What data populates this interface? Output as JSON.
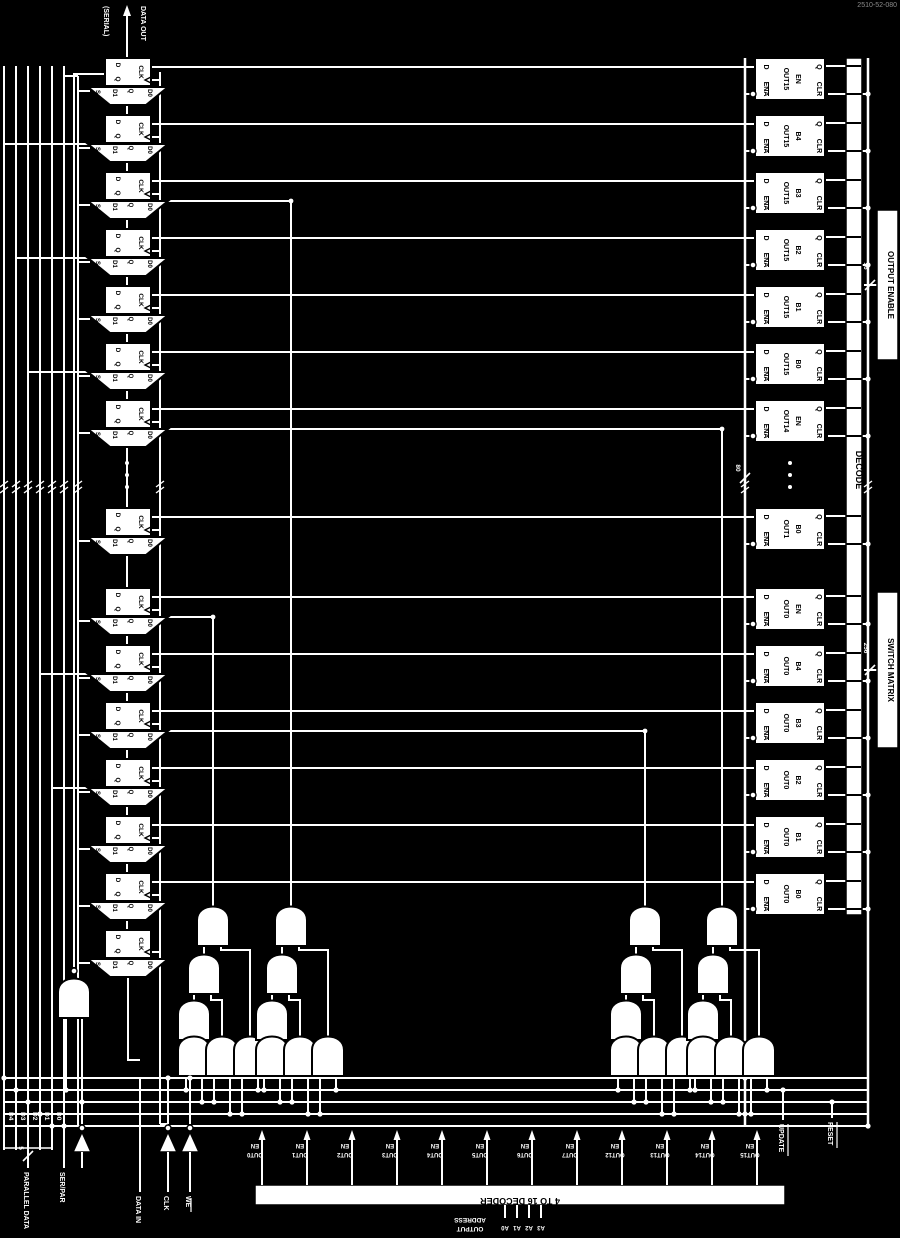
{
  "watermark": "2510-52-080",
  "colors": {
    "background": "#000000",
    "wire": "#ffffff",
    "block_fill": "#ffffff",
    "block_stroke": "#000000",
    "block_text": "#000000",
    "label_text": "#ffffff",
    "watermark_gray": "#8c8c8c"
  },
  "side_labels": {
    "decode": "DECODE",
    "output_enable": "OUTPUT ENABLE",
    "switch_matrix": "SWITCH MATRIX"
  },
  "bus_markers": {
    "enable_bus": "16",
    "matrix_bus": "256",
    "parallel_bus": "5",
    "register_bus": "80"
  },
  "latch_pins": {
    "ena": "ENA",
    "d": "D",
    "clr": "CLR",
    "q": "Q"
  },
  "ff_pins": {
    "d": "D",
    "q": "Q",
    "clk": "CLK"
  },
  "mux_pins": {
    "s": "S",
    "d1": "D1",
    "d0": "D0",
    "q": "Q"
  },
  "latches": [
    {
      "name": "OUT15",
      "bit": "EN"
    },
    {
      "name": "OUT15",
      "bit": "B4"
    },
    {
      "name": "OUT15",
      "bit": "B3"
    },
    {
      "name": "OUT15",
      "bit": "B2"
    },
    {
      "name": "OUT15",
      "bit": "B1"
    },
    {
      "name": "OUT15",
      "bit": "B0"
    },
    {
      "name": "OUT14",
      "bit": "EN"
    },
    {
      "name": "OUT1",
      "bit": "B0"
    },
    {
      "name": "OUT0",
      "bit": "EN"
    },
    {
      "name": "OUT0",
      "bit": "B4"
    },
    {
      "name": "OUT0",
      "bit": "B3"
    },
    {
      "name": "OUT0",
      "bit": "B2"
    },
    {
      "name": "OUT0",
      "bit": "B1"
    },
    {
      "name": "OUT0",
      "bit": "B0"
    }
  ],
  "decoder": {
    "title": "4 TO 16 DECODER",
    "outputs": [
      "OUT0 EN",
      "OUT1 EN",
      "OUT2 EN",
      "OUT3 EN",
      "OUT4 EN",
      "OUT5 EN",
      "OUT6 EN",
      "OUT7 EN",
      "OUT12 EN",
      "OUT13 EN",
      "OUT14 EN",
      "OUT15 EN"
    ],
    "address_pins": [
      "A0",
      "A1",
      "A2",
      "A3"
    ],
    "address_label_line1": "OUTPUT",
    "address_label_line2": "ADDRESS"
  },
  "bottom_pins": {
    "data_bits": [
      "D4",
      "D3",
      "D2",
      "D1",
      "D0"
    ],
    "parallel_data": "PARALLEL DATA",
    "ser_par": "SER/PAR",
    "data_in": "DATA IN",
    "clk": "CLK",
    "we": "WE",
    "update": "UPDATE",
    "reset": "RESET"
  },
  "top_left": {
    "line1": "DATA OUT",
    "line2": "(SERIAL)"
  }
}
